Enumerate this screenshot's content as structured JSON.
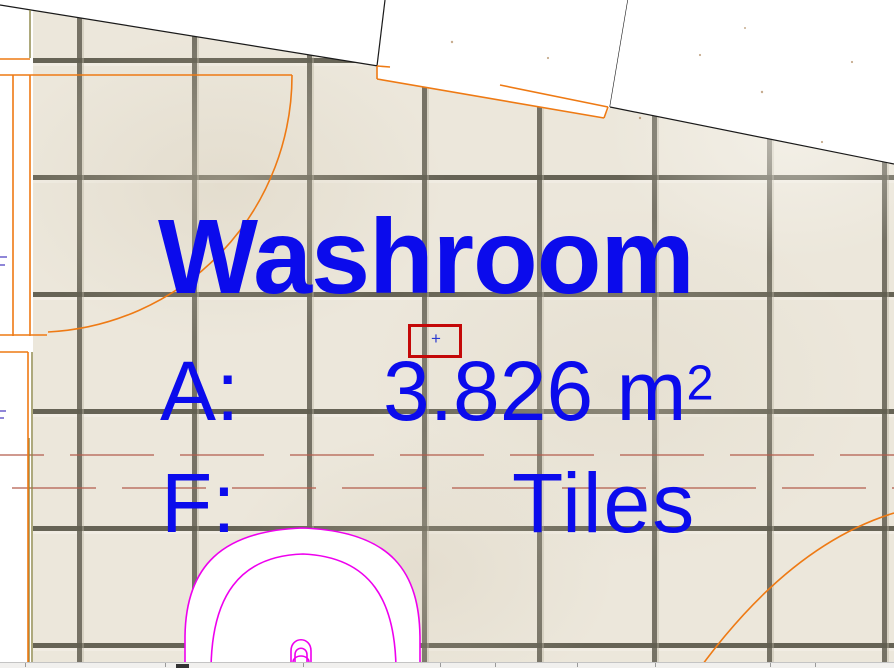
{
  "canvas": {
    "view": "floor-plan",
    "floor_texture": "ceramic-tiles"
  },
  "zone_stamp": {
    "name": "Washroom",
    "area_label": "A:",
    "area_value": "3.826 m",
    "area_exponent": "2",
    "finish_label": "F:",
    "finish_value": "Tiles",
    "text_color": "#0b0bec"
  },
  "selection_marker": {
    "cross_glyph": "+",
    "box_color": "#c40808",
    "cross_color": "#2b3bd0"
  },
  "line_colors": {
    "wall": "#1a1a1a",
    "door": "#ee7a14",
    "fixture": "#ee00ee",
    "dashed_grid": "#b35c4c",
    "frame_olive": "#8a8444",
    "annotation": "#8f86d8"
  }
}
